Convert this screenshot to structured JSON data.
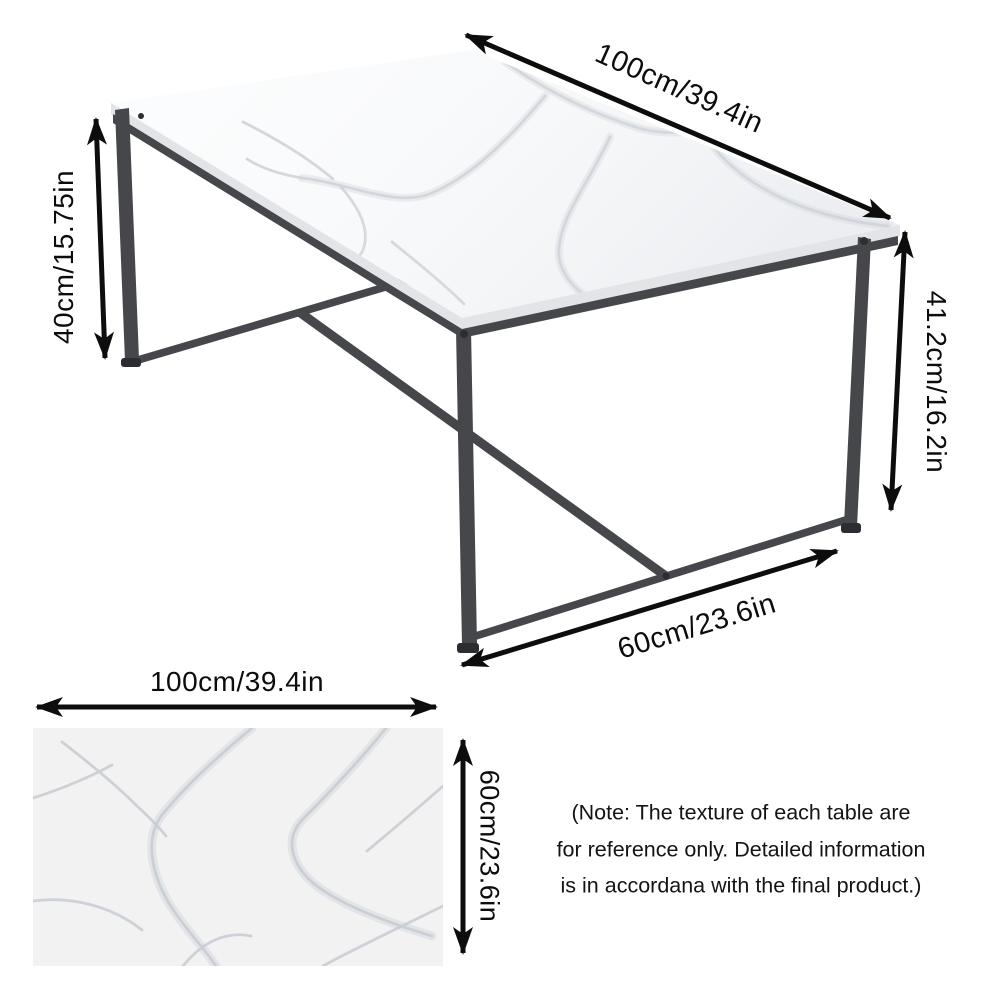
{
  "colors": {
    "arrow": "#0d0d0d",
    "frame": "#45474b",
    "frame_dark": "#2c2d30",
    "marble_bg": "#fbfcfd",
    "marble_vein": "#c7ccd2",
    "edge_band": "#e2e4e7",
    "swatch_bg": "#f2f2f3"
  },
  "table_diagram": {
    "length_label": "100cm/39.4in",
    "left_height_label": "40cm/15.75in",
    "right_height_label": "41.2cm/16.2in",
    "depth_label": "60cm/23.6in"
  },
  "swatch_diagram": {
    "width_label": "100cm/39.4in",
    "height_label": "60cm/23.6in"
  },
  "note": {
    "line1": "(Note: The texture of each table are",
    "line2": "for reference only. Detailed information",
    "line3": "is in accordana with the final product.)"
  }
}
